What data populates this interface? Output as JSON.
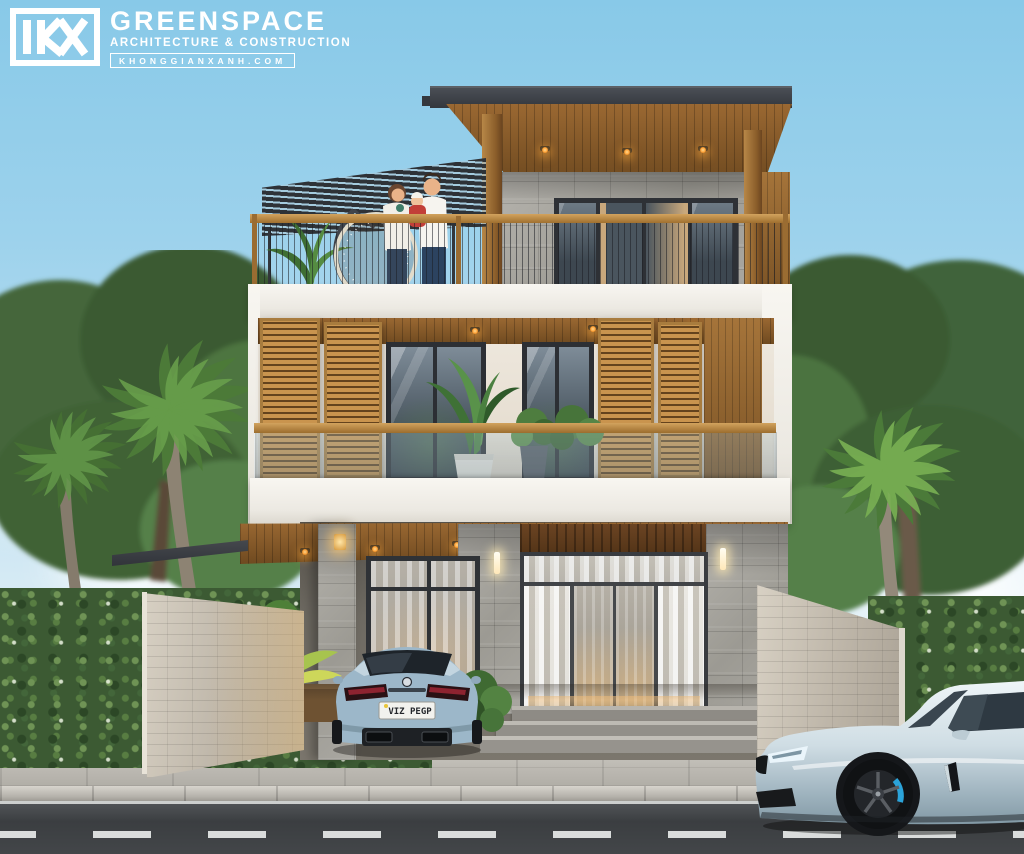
{
  "logo": {
    "mark": "KX",
    "name": "GREENSPACE",
    "tagline": "ARCHITECTURE & CONSTRUCTION",
    "website": "KHONGGIANXANH.COM"
  },
  "vehicles": {
    "driveway_car_plate": "VIZ PEGP"
  },
  "palette": {
    "sky": "#88c9e8",
    "roof_fascia": "#383c42",
    "soffit_wood": "#916130",
    "slat_wood": "#c5914a",
    "stone_cladding": "#a5a39c",
    "white_trim": "#f4f2ec",
    "hedge_green": "#3c5a33",
    "road_asphalt": "#434649",
    "driveway_warm": "#e2cda0",
    "driveway_car_blue": "#9cb7c9",
    "street_car_ice": "#d6e3ea",
    "brake_caliper_blue": "#2ba3d9",
    "downlight_amber": "#ffb250"
  }
}
